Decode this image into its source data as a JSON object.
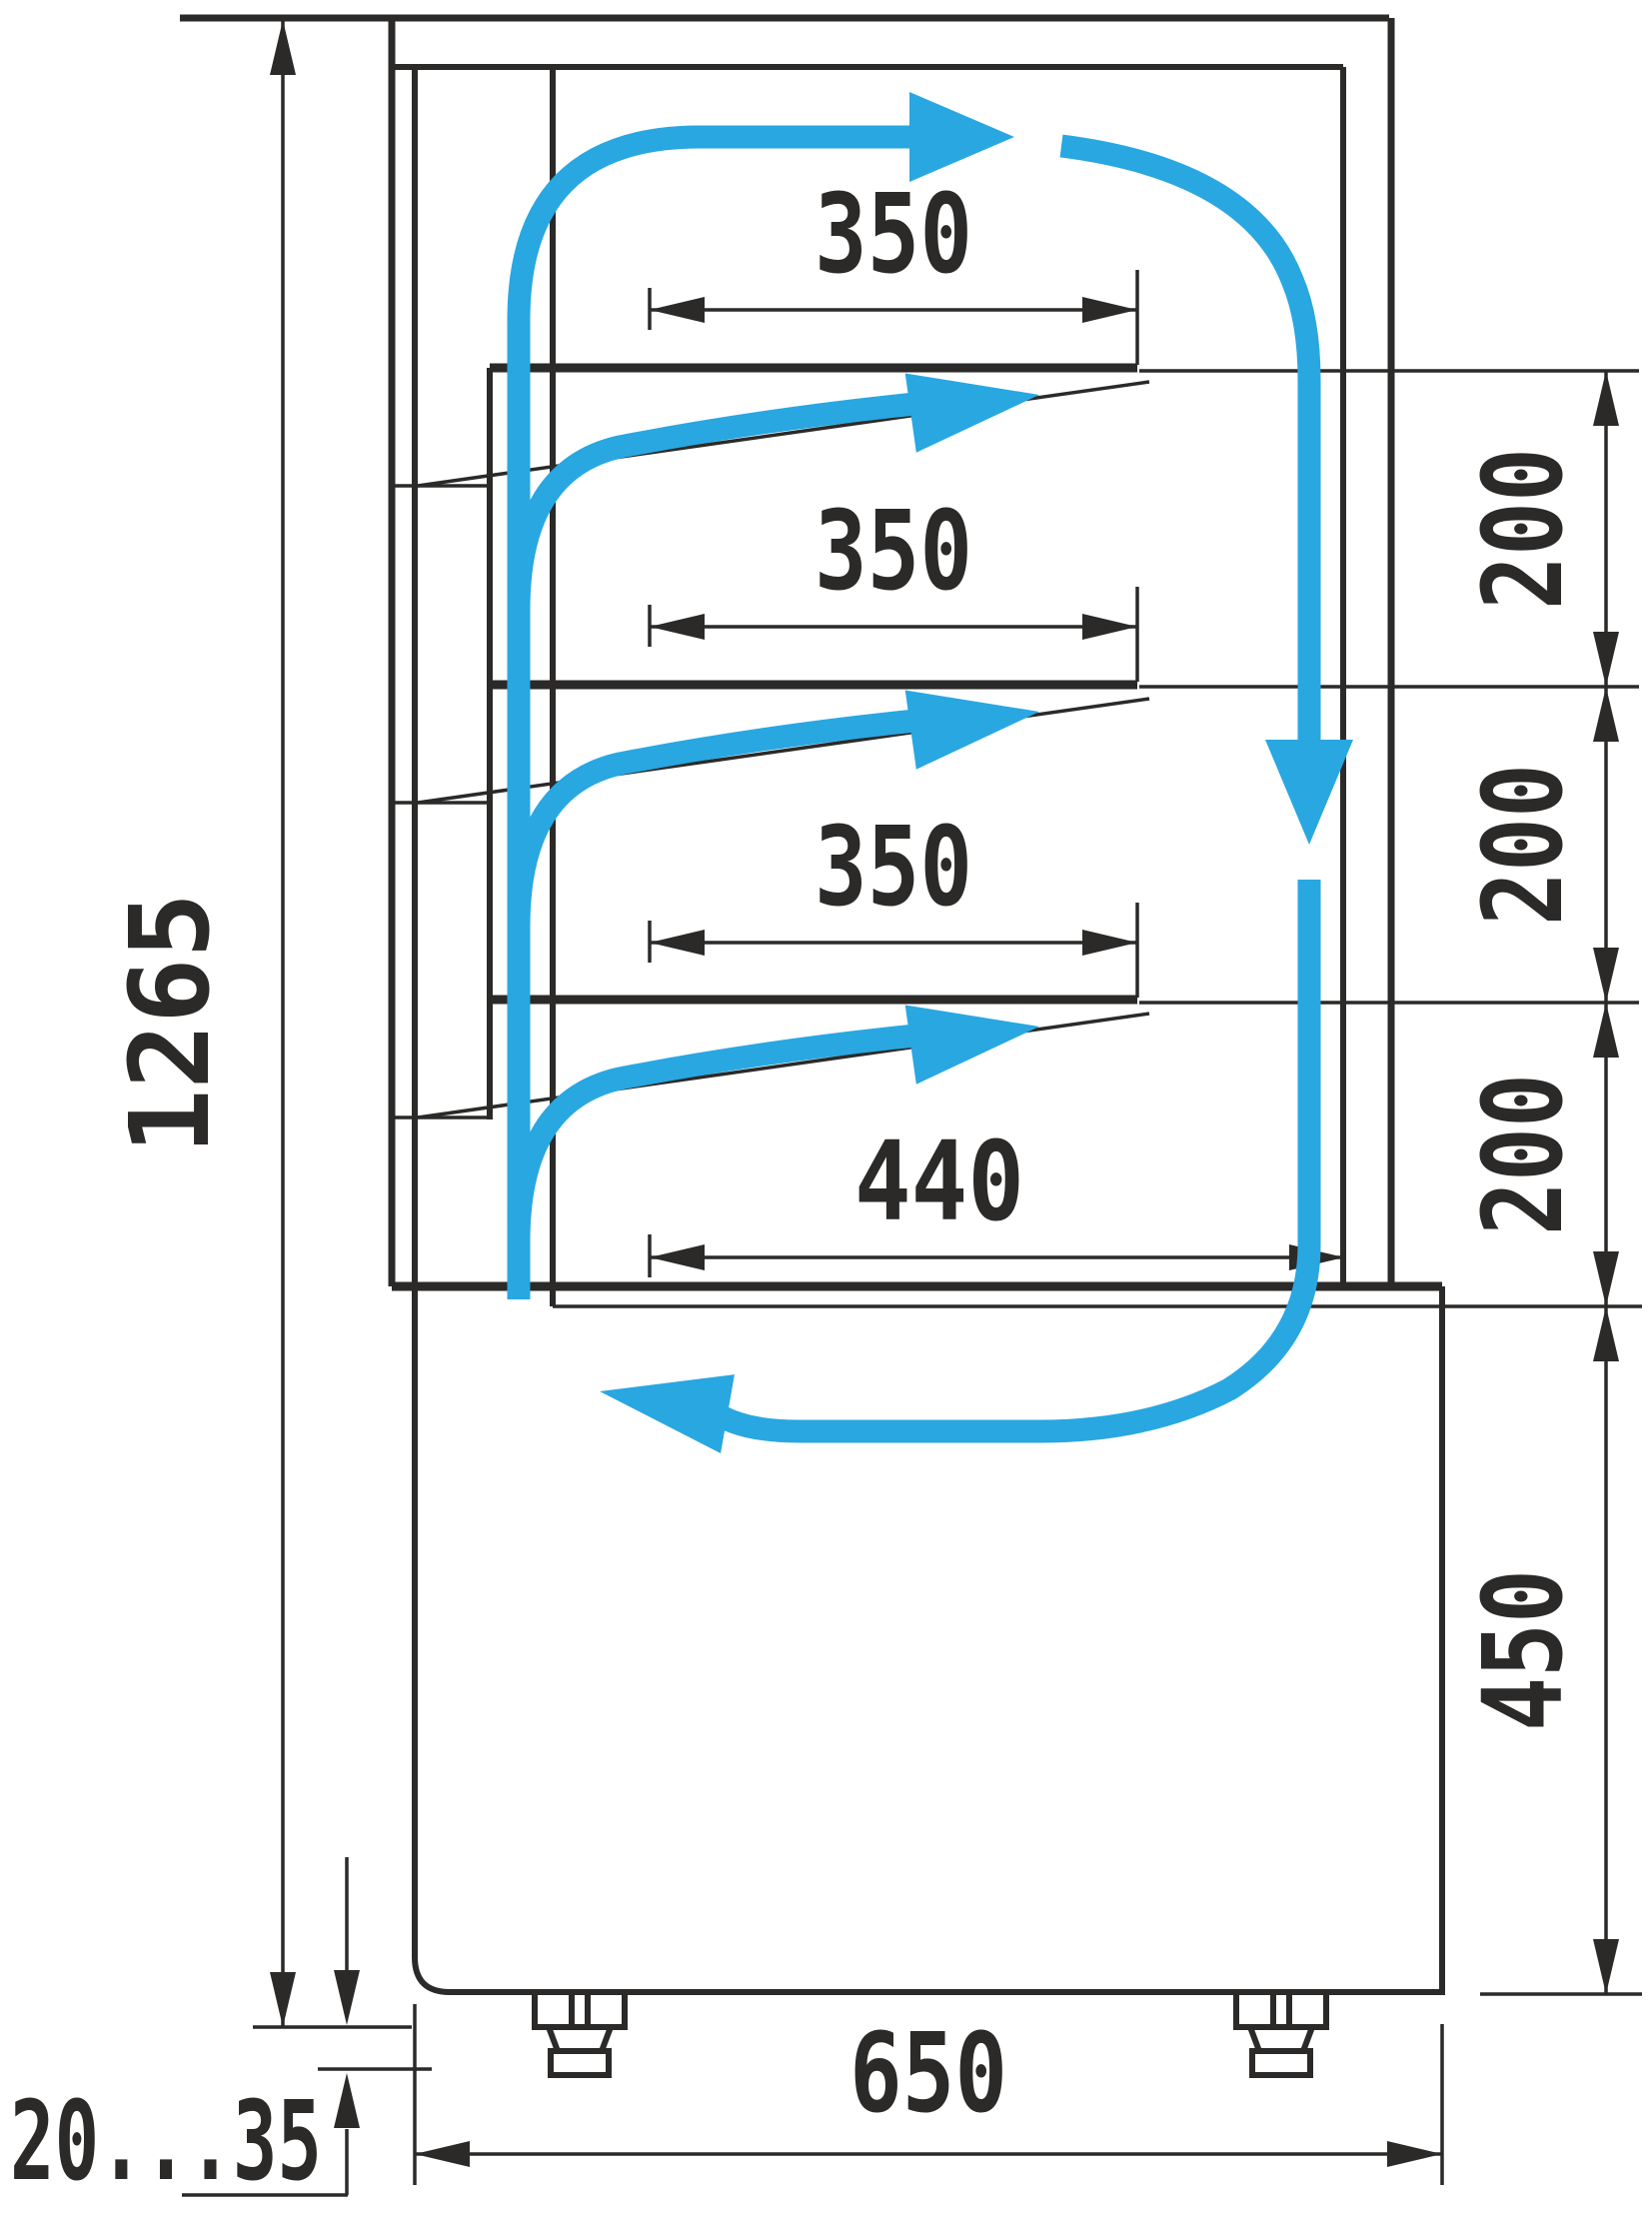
{
  "diagram": {
    "kind": "technical-drawing",
    "subject": "refrigerated-cake-display-case-side-section-with-airflow",
    "units": "mm",
    "colors": {
      "line": "#2b2a29",
      "airflow": "#29a7e1",
      "background": "#ffffff"
    },
    "dimensions": {
      "overall_height": {
        "label": "1265"
      },
      "shelf_depth_top": {
        "label": "350"
      },
      "shelf_depth_middle": {
        "label": "350"
      },
      "shelf_depth_lower": {
        "label": "350"
      },
      "bottom_shelf_depth": {
        "label": "440"
      },
      "shelf_gap_1": {
        "label": "200"
      },
      "shelf_gap_2": {
        "label": "200"
      },
      "shelf_gap_3": {
        "label": "200"
      },
      "base_height": {
        "label": "450"
      },
      "base_depth": {
        "label": "650"
      },
      "foot_adjust_range": {
        "label": "20...35"
      }
    }
  }
}
